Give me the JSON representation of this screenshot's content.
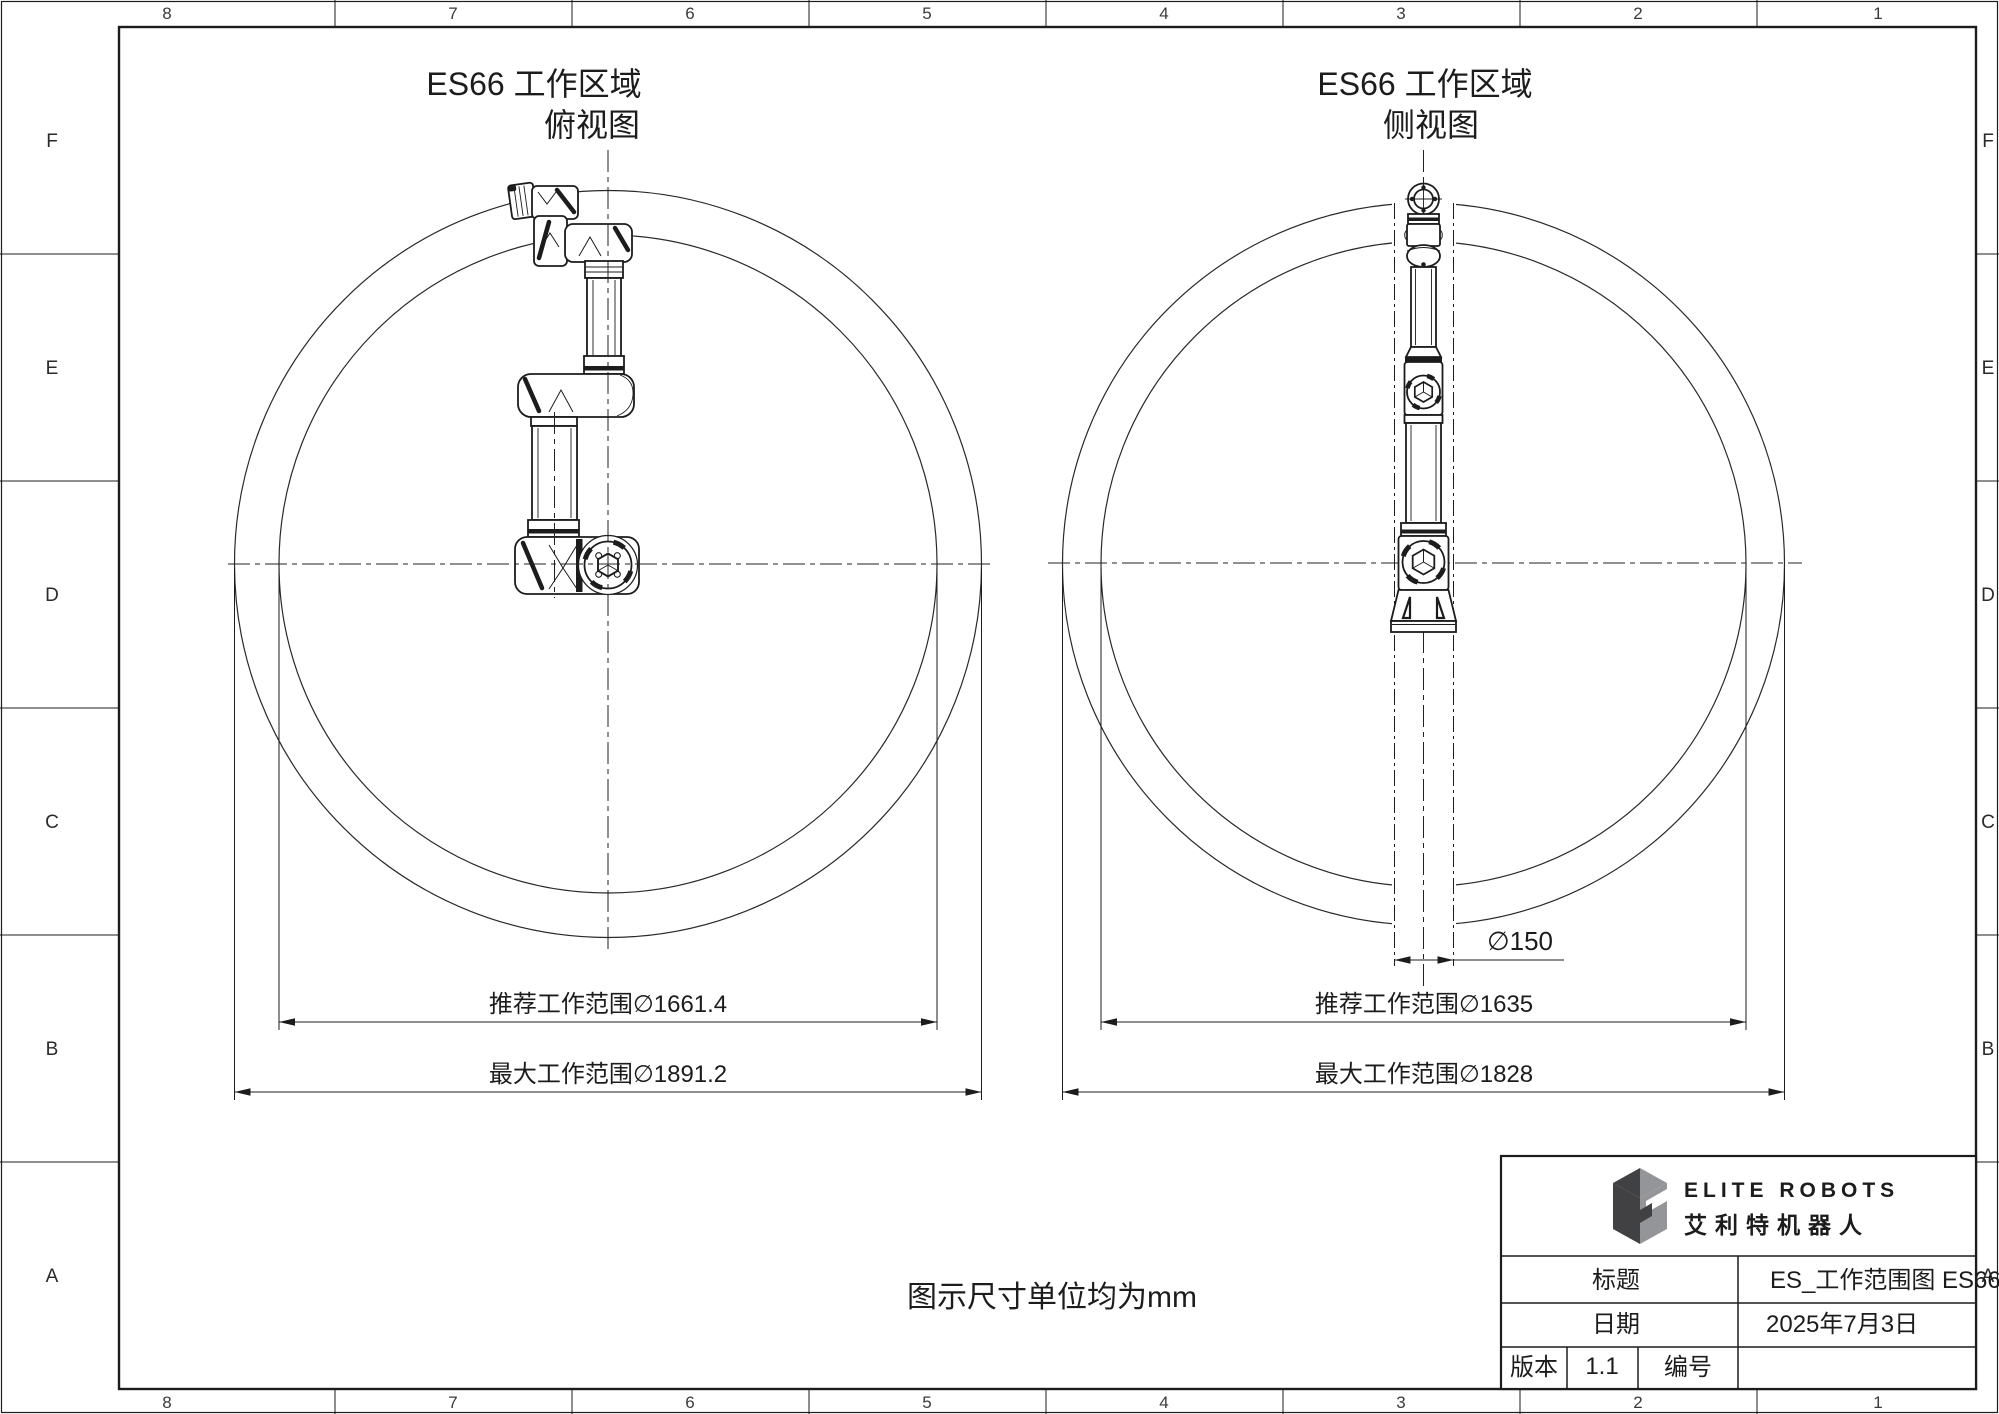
{
  "frame": {
    "h_zones": [
      "8",
      "7",
      "6",
      "5",
      "4",
      "3",
      "2",
      "1"
    ],
    "v_zones": [
      "F",
      "E",
      "D",
      "C",
      "B",
      "A"
    ]
  },
  "top_view": {
    "title_line1": "ES66 工作区域",
    "title_line2": "俯视图",
    "dim_recommended": "推荐工作范围∅1661.4",
    "dim_max": "最大工作范围∅1891.2"
  },
  "side_view": {
    "title_line1": "ES66 工作区域",
    "title_line2": "侧视图",
    "dim_column": "∅150",
    "dim_recommended": "推荐工作范围∅1635",
    "dim_max": "最大工作范围∅1828"
  },
  "note": "图示尺寸单位均为mm",
  "title_block": {
    "brand_en": "ELITE ROBOTS",
    "brand_cn": "艾利特机器人",
    "title_label": "标题",
    "title_value": "ES_工作范围图 ES66",
    "date_label": "日期",
    "date_value": "2025年7月3日",
    "version_label": "版本",
    "version_value": "1.1",
    "number_label": "编号",
    "number_value": ""
  },
  "colors": {
    "line": "#1c1c1c",
    "logo_dark": "#414042",
    "logo_gray": "#939598"
  }
}
